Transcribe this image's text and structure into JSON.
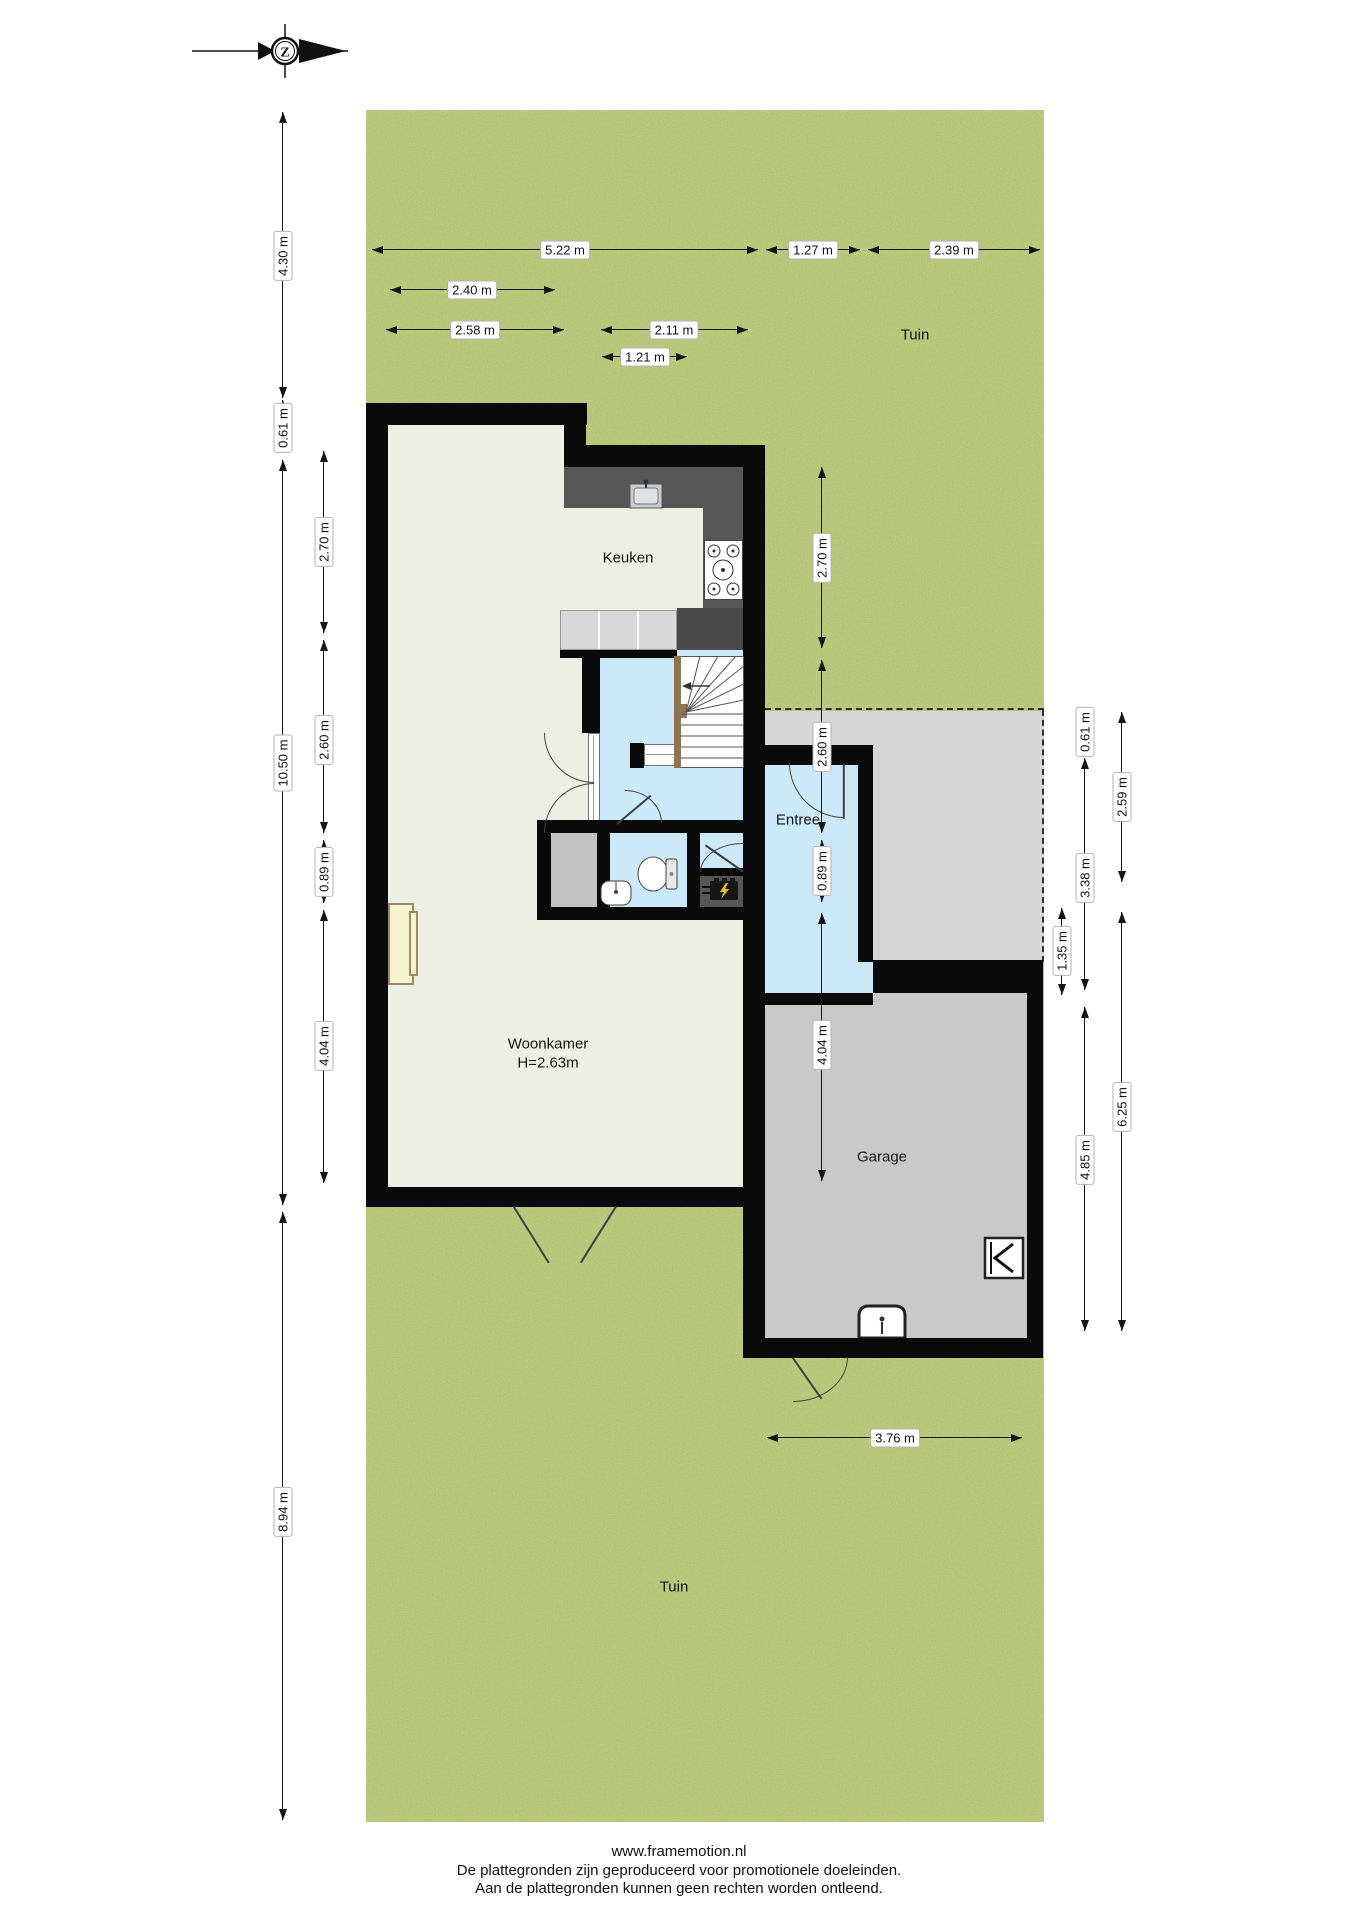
{
  "compass": {
    "letter": "Z"
  },
  "garden": {
    "label_top": "Tuin",
    "label_bottom": "Tuin"
  },
  "rooms": {
    "kitchen": "Keuken",
    "entry": "Entree",
    "living": "Woonkamer",
    "living_height": "H=2.63m",
    "garage": "Garage"
  },
  "dims": {
    "d522": "5.22 m",
    "d127": "1.27 m",
    "d239": "2.39 m",
    "d240": "2.40 m",
    "d258": "2.58 m",
    "d211": "2.11 m",
    "d121": "1.21 m",
    "d430": "4.30 m",
    "l061": "0.61 m",
    "d1050": "10.50 m",
    "d894": "8.94 m",
    "l270": "2.70 m",
    "l260": "2.60 m",
    "l089": "0.89 m",
    "l404": "4.04 m",
    "m270": "2.70 m",
    "m260": "2.60 m",
    "m089": "0.89 m",
    "m404": "4.04 m",
    "r135": "1.35 m",
    "r061": "0.61 m",
    "r338": "3.38 m",
    "r485": "4.85 m",
    "r259": "2.59 m",
    "r625": "6.25 m",
    "b376": "3.76 m"
  },
  "footer": {
    "site": "www.framemotion.nl",
    "line1": "De plattegronden zijn geproduceerd voor promotionele doeleinden.",
    "line2": "Aan de plattegronden kunnen geen rechten worden ontleend."
  }
}
